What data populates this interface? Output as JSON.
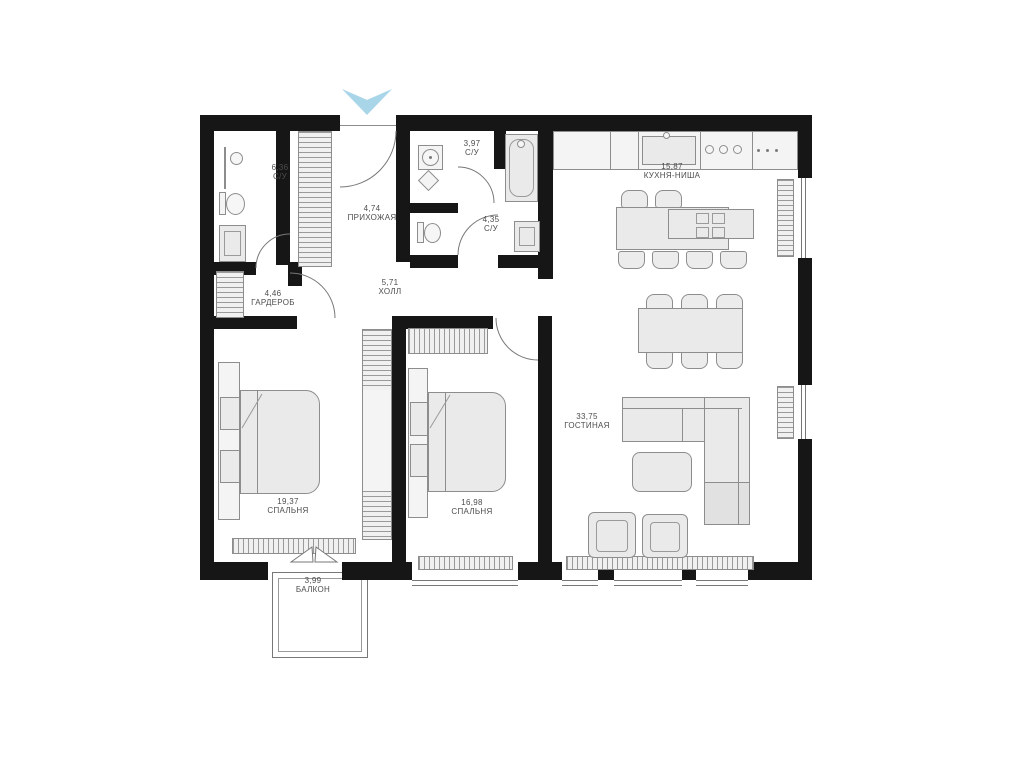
{
  "floorplan": {
    "rooms": [
      {
        "area": "6,36",
        "name": "С/У"
      },
      {
        "area": "4,74",
        "name": "ПРИХОЖАЯ"
      },
      {
        "area": "3,97",
        "name": "С/У"
      },
      {
        "area": "4,35",
        "name": "С/У"
      },
      {
        "area": "15,87",
        "name": "КУХНЯ-НИША"
      },
      {
        "area": "5,71",
        "name": "ХОЛЛ"
      },
      {
        "area": "4,46",
        "name": "ГАРДЕРОБ"
      },
      {
        "area": "19,37",
        "name": "СПАЛЬНЯ"
      },
      {
        "area": "16,98",
        "name": "СПАЛЬНЯ"
      },
      {
        "area": "33,75",
        "name": "ГОСТИНАЯ"
      },
      {
        "area": "3,99",
        "name": "БАЛКОН"
      }
    ],
    "colors": {
      "wall": "#161616",
      "furniture_fill": "#eaeaea",
      "furniture_line": "#8d8d8d",
      "entrance_marker": "#a9d5e9",
      "background": "#ffffff"
    }
  }
}
